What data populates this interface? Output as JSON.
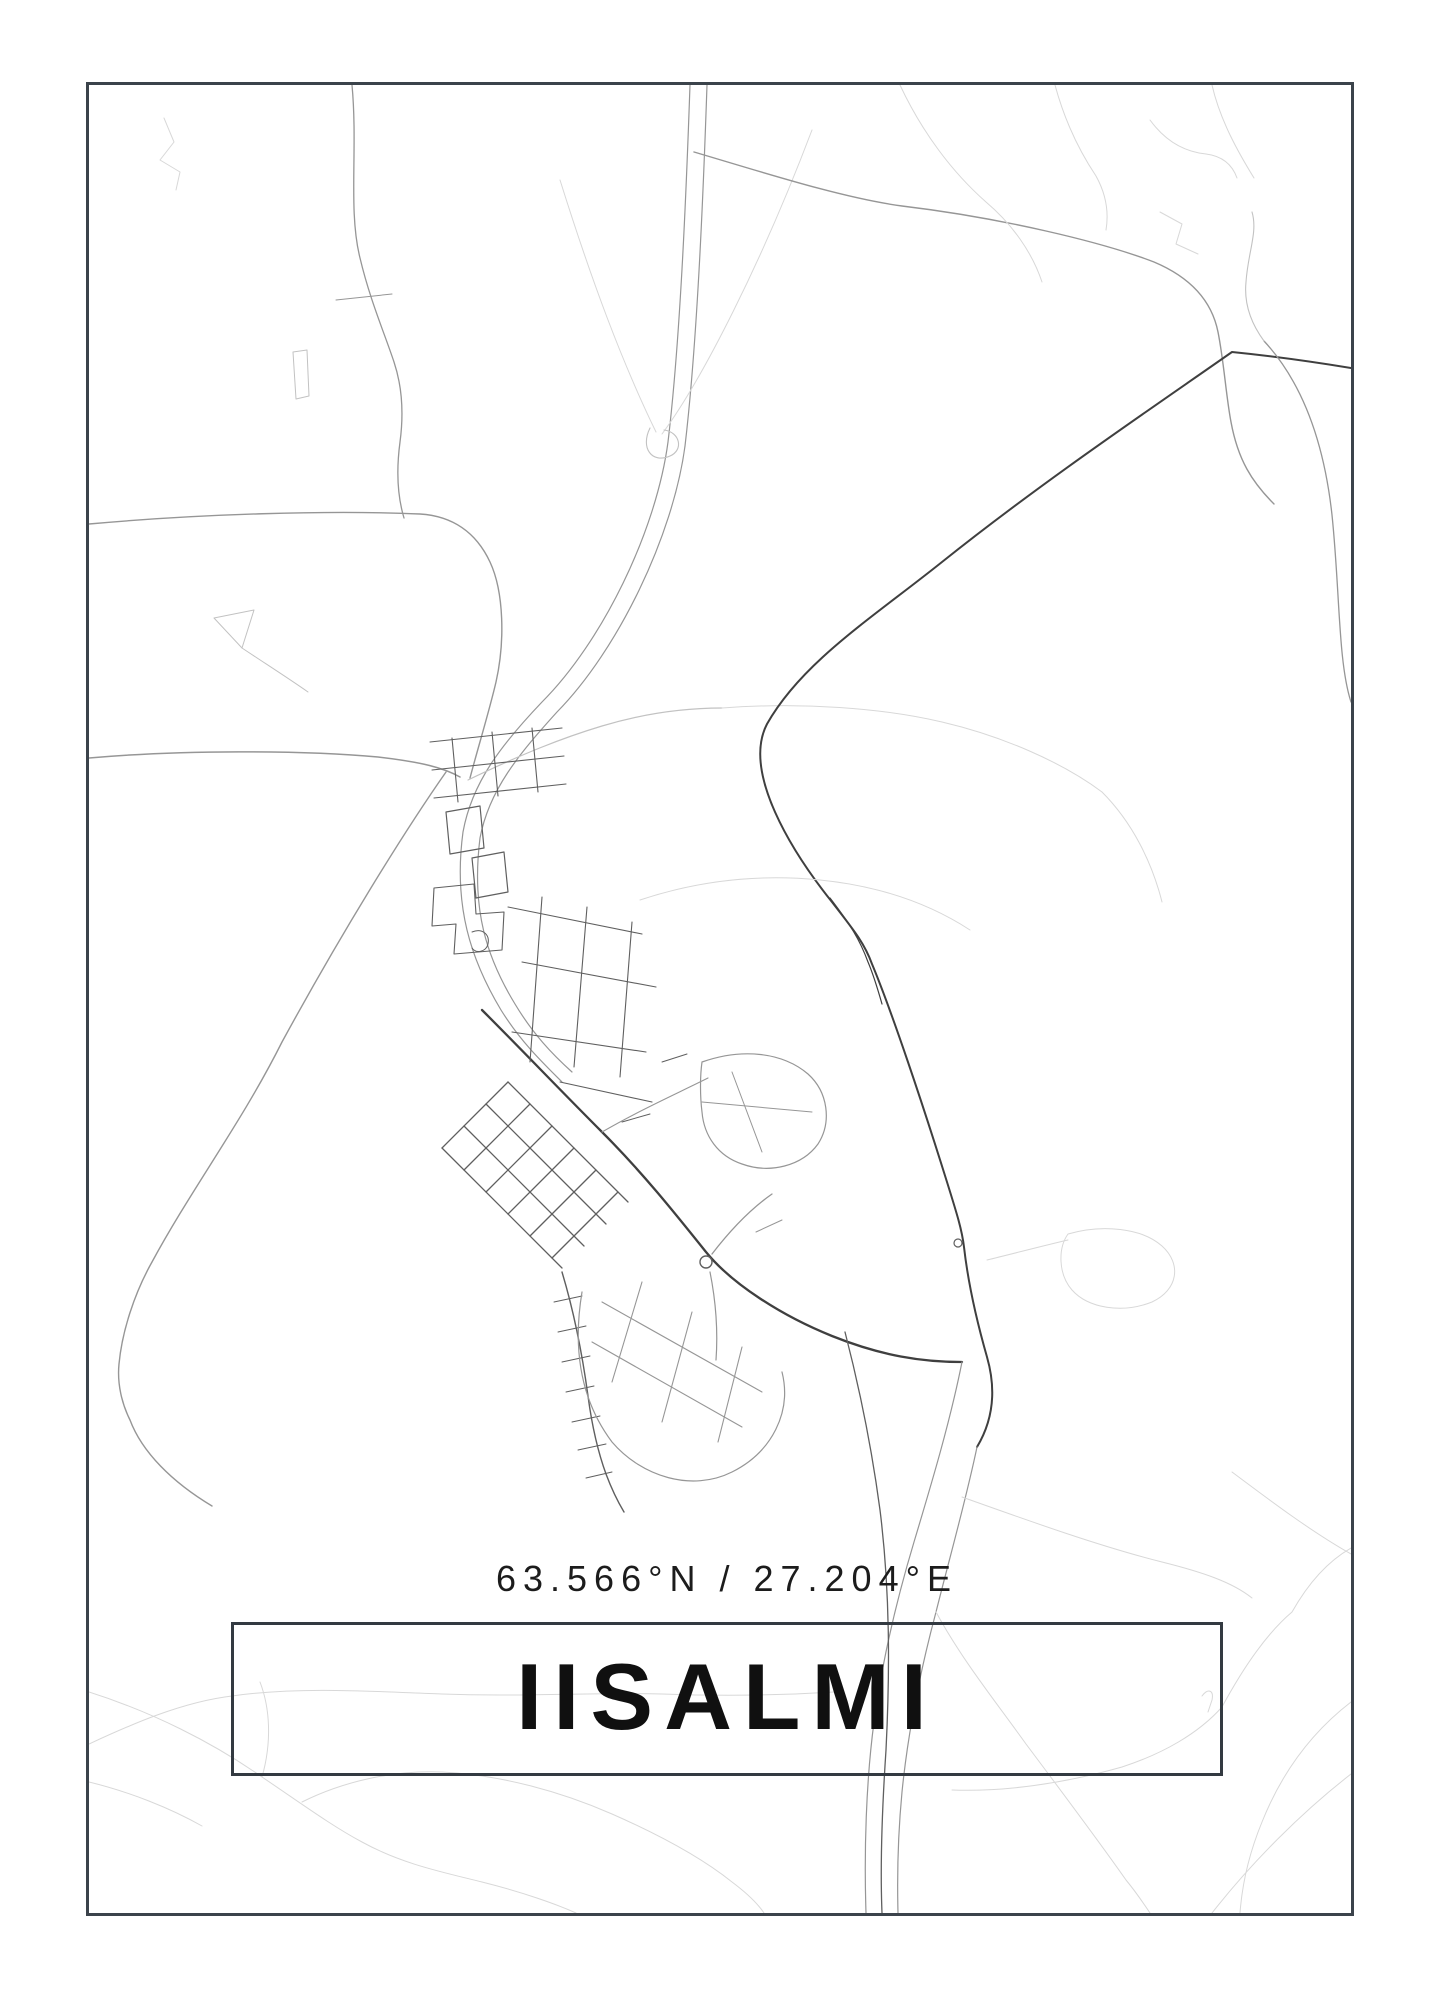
{
  "poster": {
    "title": "IISALMI",
    "coordinates": "63.566°N / 27.204°E"
  },
  "colors": {
    "background": "#ffffff",
    "frame_border": "#3b434b",
    "title_box_border": "#333a41",
    "title_text": "#101010",
    "coordinates_text": "#1c1c1c",
    "road_very_light": "#d8d8d8",
    "road_light": "#c2c2c2",
    "road_medium": "#969696",
    "road_dark": "#5f5f5f",
    "road_darkest": "#3f3f3f"
  },
  "map": {
    "name": "iisalmi-street-map",
    "roads": [
      {
        "d": "M164,118 L174,142 L160,160 L180,172 L176,190",
        "c": "#d8d8d8",
        "w": 1
      },
      {
        "d": "M352,85 C358,150 348,210 360,258 C370,300 384,332 394,362 C402,386 404,412 400,442 C396,472 398,498 404,518",
        "c": "#969696",
        "w": 1.3
      },
      {
        "d": "M336,300 L392,294",
        "c": "#969696",
        "w": 1
      },
      {
        "d": "M293,352 L307,350 L309,396 L296,399 Z",
        "c": "#c2c2c2",
        "w": 1
      },
      {
        "d": "M214,618 L254,610 L242,648 Z",
        "c": "#c2c2c2",
        "w": 1
      },
      {
        "d": "M242,648 C266,664 288,678 308,692",
        "c": "#c2c2c2",
        "w": 1
      },
      {
        "d": "M89,524 C200,514 330,510 420,514 C452,516 476,532 490,562 C504,592 505,642 496,682 C489,712 479,744 470,778",
        "c": "#969696",
        "w": 1.4
      },
      {
        "d": "M89,758 C180,750 300,750 378,757 C422,762 444,768 460,777",
        "c": "#969696",
        "w": 1.5
      },
      {
        "d": "M446,772 C404,832 342,932 282,1042 C242,1122 192,1188 152,1262 C134,1294 122,1332 119,1364 C117,1384 122,1404 130,1420 C142,1452 172,1482 212,1506",
        "c": "#969696",
        "w": 1.4
      },
      {
        "d": "M690,85 C686,200 680,342 668,442 C656,532 602,642 542,702 C502,744 472,782 463,832 C453,906 471,960 501,1010 C521,1042 542,1062 562,1082",
        "c": "#969696",
        "w": 1.2
      },
      {
        "d": "M707,85 C703,202 697,344 685,446 C673,536 618,650 557,712 C519,754 489,790 480,838 C471,910 487,958 515,1004 C533,1034 552,1054 572,1072",
        "c": "#969696",
        "w": 1.2
      },
      {
        "d": "M560,180 C592,282 622,362 656,432",
        "c": "#d8d8d8",
        "w": 1
      },
      {
        "d": "M812,130 C762,262 702,380 662,434",
        "c": "#d8d8d8",
        "w": 1
      },
      {
        "d": "M650,428 C640,448 652,464 670,456 C684,450 680,432 664,430",
        "c": "#c2c2c2",
        "w": 1.1
      },
      {
        "d": "M468,780 C522,754 562,738 602,726 C642,714 682,708 722,708",
        "c": "#c2c2c2",
        "w": 1.2
      },
      {
        "d": "M722,708 C802,702 882,708 942,722 C1002,736 1062,762 1102,792",
        "c": "#d8d8d8",
        "w": 1
      },
      {
        "d": "M1102,792 C1132,822 1152,862 1162,902",
        "c": "#d8d8d8",
        "w": 1
      },
      {
        "d": "M694,152 C762,172 842,198 902,206 C1002,218 1102,242 1154,262 C1192,278 1212,302 1218,332 C1224,362 1226,396 1231,422 C1238,460 1252,482 1274,504",
        "c": "#969696",
        "w": 1.4
      },
      {
        "d": "M1351,368 C1302,360 1262,355 1232,352 C1152,408 1042,482 942,562 C872,618 802,662 767,724 C742,772 792,852 832,902 C852,928 864,942 872,964 C892,1012 922,1102 947,1182 C957,1214 962,1230 964,1247 C968,1282 977,1322 987,1357 C997,1392 992,1422 977,1447",
        "c": "#3f3f3f",
        "w": 2
      },
      {
        "d": "M830,898 C850,924 860,940 868,962 C874,976 878,990 882,1004",
        "c": "#3f3f3f",
        "w": 1.2
      },
      {
        "d": "M1264,341 C1302,382 1324,442 1332,515 C1340,592 1338,662 1351,702",
        "c": "#969696",
        "w": 1.3
      },
      {
        "d": "M1264,341 C1250,322 1244,302 1246,282 C1248,252 1258,232 1252,212",
        "c": "#c2c2c2",
        "w": 1.1
      },
      {
        "d": "M1212,85 C1220,120 1238,152 1254,178",
        "c": "#d8d8d8",
        "w": 1
      },
      {
        "d": "M1055,85 C1065,122 1080,152 1096,176 C1106,194 1109,212 1106,230",
        "c": "#d8d8d8",
        "w": 1
      },
      {
        "d": "M1150,120 C1166,142 1186,152 1206,154 C1222,156 1232,164 1237,178",
        "c": "#d8d8d8",
        "w": 1
      },
      {
        "d": "M1160,212 L1182,224 L1176,244 L1198,254",
        "c": "#d8d8d8",
        "w": 1
      },
      {
        "d": "M900,85 C922,132 952,172 986,202 C1012,224 1032,252 1042,282",
        "c": "#d8d8d8",
        "w": 1
      },
      {
        "d": "M482,1010 C522,1050 562,1092 602,1132 C642,1172 674,1212 706,1252 C732,1284 782,1316 832,1336 C882,1356 922,1362 962,1362",
        "c": "#3f3f3f",
        "w": 2.3
      },
      {
        "type": "circle",
        "cx": 706,
        "cy": 1262,
        "r": 6,
        "c": "#5f5f5f",
        "w": 1.4
      },
      {
        "d": "M712,1254 C732,1228 752,1208 772,1194",
        "c": "#969696",
        "w": 1.3
      },
      {
        "d": "M710,1272 C716,1302 718,1332 716,1360",
        "c": "#969696",
        "w": 1.2
      },
      {
        "type": "circle",
        "cx": 958,
        "cy": 1243,
        "r": 4,
        "c": "#5f5f5f",
        "w": 1.2
      },
      {
        "d": "M602,1132 C640,1110 676,1094 708,1078",
        "c": "#969696",
        "w": 1.1
      },
      {
        "d": "M640,900 C700,880 760,874 820,880 C880,886 930,904 970,930",
        "c": "#d8d8d8",
        "w": 1
      },
      {
        "d": "M430,742 L562,728",
        "c": "#5f5f5f",
        "w": 1.1
      },
      {
        "d": "M432,770 L564,756",
        "c": "#5f5f5f",
        "w": 1.1
      },
      {
        "d": "M434,798 L566,784",
        "c": "#5f5f5f",
        "w": 1.1
      },
      {
        "d": "M452,738 L458,802",
        "c": "#5f5f5f",
        "w": 1.1
      },
      {
        "d": "M492,732 L498,796",
        "c": "#5f5f5f",
        "w": 1.1
      },
      {
        "d": "M532,728 L538,792",
        "c": "#5f5f5f",
        "w": 1.1
      },
      {
        "d": "M446,812 L480,806 L484,848 L450,854 Z",
        "c": "#5f5f5f",
        "w": 1.2
      },
      {
        "d": "M472,858 L504,852 L508,892 L476,898 Z",
        "c": "#5f5f5f",
        "w": 1.2
      },
      {
        "d": "M434,888 L474,884 L476,914 L504,912 L502,950 L454,954 L456,924 L432,926 Z",
        "c": "#5f5f5f",
        "w": 1.1
      },
      {
        "d": "M472,932 C482,928 490,934 488,944 C486,952 476,954 472,948",
        "c": "#5f5f5f",
        "w": 1
      },
      {
        "d": "M508,907 L642,934",
        "c": "#5f5f5f",
        "w": 1.1
      },
      {
        "d": "M522,962 L656,987",
        "c": "#5f5f5f",
        "w": 1.1
      },
      {
        "d": "M512,1032 L646,1052",
        "c": "#5f5f5f",
        "w": 1.1
      },
      {
        "d": "M542,897 L530,1062",
        "c": "#5f5f5f",
        "w": 1.1
      },
      {
        "d": "M587,907 L574,1067",
        "c": "#5f5f5f",
        "w": 1.1
      },
      {
        "d": "M632,922 L620,1077",
        "c": "#5f5f5f",
        "w": 1.1
      },
      {
        "d": "M560,1082 L652,1102",
        "c": "#5f5f5f",
        "w": 1.1
      },
      {
        "d": "M622,1122 L650,1114",
        "c": "#5f5f5f",
        "w": 1
      },
      {
        "d": "M662,1062 L687,1054",
        "c": "#5f5f5f",
        "w": 1
      },
      {
        "d": "M702,1062 C742,1048 782,1052 808,1074 C828,1092 832,1122 818,1144 C802,1166 770,1174 742,1164 C718,1156 704,1136 702,1112 C700,1096 700,1076 702,1062 Z",
        "c": "#969696",
        "w": 1.2
      },
      {
        "d": "M732,1072 L762,1152",
        "c": "#969696",
        "w": 1
      },
      {
        "d": "M702,1102 L812,1112",
        "c": "#969696",
        "w": 1
      },
      {
        "d": "M442,1148 L562,1268",
        "c": "#5f5f5f",
        "w": 1.3
      },
      {
        "d": "M464,1126 L584,1246",
        "c": "#5f5f5f",
        "w": 1.3
      },
      {
        "d": "M486,1104 L606,1224",
        "c": "#5f5f5f",
        "w": 1.3
      },
      {
        "d": "M508,1082 L628,1202",
        "c": "#5f5f5f",
        "w": 1.3
      },
      {
        "d": "M442,1148 L508,1082",
        "c": "#5f5f5f",
        "w": 1.3
      },
      {
        "d": "M464,1170 L530,1104",
        "c": "#5f5f5f",
        "w": 1.3
      },
      {
        "d": "M486,1192 L552,1126",
        "c": "#5f5f5f",
        "w": 1.3
      },
      {
        "d": "M508,1214 L574,1148",
        "c": "#5f5f5f",
        "w": 1.3
      },
      {
        "d": "M530,1236 L596,1170",
        "c": "#5f5f5f",
        "w": 1.3
      },
      {
        "d": "M552,1258 L618,1192",
        "c": "#5f5f5f",
        "w": 1.3
      },
      {
        "d": "M562,1272 C574,1312 582,1352 588,1396 C592,1426 598,1452 606,1474 C612,1490 618,1502 624,1512",
        "c": "#5f5f5f",
        "w": 1.4
      },
      {
        "d": "M554,1302 L582,1296",
        "c": "#5f5f5f",
        "w": 1
      },
      {
        "d": "M558,1332 L586,1326",
        "c": "#5f5f5f",
        "w": 1
      },
      {
        "d": "M562,1362 L590,1356",
        "c": "#5f5f5f",
        "w": 1
      },
      {
        "d": "M566,1392 L594,1386",
        "c": "#5f5f5f",
        "w": 1
      },
      {
        "d": "M572,1422 L600,1416",
        "c": "#5f5f5f",
        "w": 1
      },
      {
        "d": "M578,1450 L606,1444",
        "c": "#5f5f5f",
        "w": 1
      },
      {
        "d": "M586,1478 L612,1472",
        "c": "#5f5f5f",
        "w": 1
      },
      {
        "d": "M582,1292 C572,1352 582,1402 612,1442 C642,1477 692,1492 732,1472 C772,1452 792,1412 782,1372",
        "c": "#969696",
        "w": 1.2
      },
      {
        "d": "M602,1302 L762,1392",
        "c": "#969696",
        "w": 1.1
      },
      {
        "d": "M592,1342 L742,1427",
        "c": "#969696",
        "w": 1.1
      },
      {
        "d": "M642,1282 L612,1382",
        "c": "#969696",
        "w": 1.1
      },
      {
        "d": "M692,1312 L662,1422",
        "c": "#969696",
        "w": 1.1
      },
      {
        "d": "M742,1347 L718,1442",
        "c": "#969696",
        "w": 1.1
      },
      {
        "d": "M756,1232 L782,1220",
        "c": "#969696",
        "w": 1
      },
      {
        "d": "M962,1362 C950,1422 932,1482 914,1542 C896,1602 882,1662 874,1722 C866,1782 864,1852 866,1913",
        "c": "#969696",
        "w": 1.2
      },
      {
        "d": "M977,1447 C966,1500 950,1556 936,1612 C920,1672 908,1732 902,1792 C898,1834 897,1874 898,1913",
        "c": "#969696",
        "w": 1.2
      },
      {
        "d": "M845,1332 C860,1390 872,1450 880,1510 C890,1590 890,1670 886,1750 C882,1810 880,1864 882,1913",
        "c": "#5f5f5f",
        "w": 1.3
      },
      {
        "d": "M936,1612 C962,1660 996,1702 1026,1744 C1062,1792 1098,1840 1126,1880 C1136,1892 1144,1904 1150,1913",
        "c": "#d8d8d8",
        "w": 1
      },
      {
        "d": "M89,1692 C152,1712 212,1742 262,1777 C302,1804 332,1826 362,1842 C402,1864 442,1872 482,1882 C522,1892 556,1904 576,1913",
        "c": "#d8d8d8",
        "w": 1
      },
      {
        "d": "M302,1802 C342,1782 392,1770 442,1772 C502,1775 562,1792 612,1814 C662,1836 702,1858 732,1882 C748,1894 758,1904 764,1913",
        "c": "#d8d8d8",
        "w": 1
      },
      {
        "d": "M89,1782 C130,1792 170,1808 202,1826",
        "c": "#d8d8d8",
        "w": 1
      },
      {
        "d": "M262,1777 C272,1742 270,1708 260,1682",
        "c": "#d8d8d8",
        "w": 1
      },
      {
        "d": "M89,1744 C132,1724 182,1702 232,1696 C302,1686 382,1692 442,1694 C522,1697 602,1692 662,1694 C742,1697 802,1694 834,1692",
        "c": "#d8d8d8",
        "w": 1
      },
      {
        "d": "M1351,1548 C1330,1560 1310,1580 1292,1612 C1266,1634 1242,1670 1222,1707 C1198,1734 1162,1754 1122,1767 C1062,1784 1002,1792 952,1790",
        "c": "#d8d8d8",
        "w": 1
      },
      {
        "d": "M1202,1696 C1208,1688 1214,1690 1212,1700 L1208,1712",
        "c": "#d8d8d8",
        "w": 1
      },
      {
        "d": "M1232,1472 C1272,1502 1312,1532 1351,1554",
        "c": "#d8d8d8",
        "w": 1
      },
      {
        "d": "M962,1497 C1032,1522 1102,1547 1162,1562 C1202,1572 1232,1582 1252,1598",
        "c": "#d8d8d8",
        "w": 1
      },
      {
        "d": "M1351,1702 C1312,1732 1282,1772 1262,1822 C1248,1856 1242,1886 1240,1913",
        "c": "#d8d8d8",
        "w": 1
      },
      {
        "d": "M1212,1913 C1252,1862 1302,1812 1351,1774",
        "c": "#d8d8d8",
        "w": 1
      },
      {
        "d": "M987,1260 C1012,1254 1042,1246 1068,1240",
        "c": "#d8d8d8",
        "w": 1
      },
      {
        "d": "M1068,1234 C1102,1224 1142,1228 1162,1246 C1182,1264 1178,1290 1152,1302 C1122,1314 1088,1308 1072,1290 C1058,1274 1058,1248 1068,1234 Z",
        "c": "#d8d8d8",
        "w": 1
      }
    ]
  }
}
